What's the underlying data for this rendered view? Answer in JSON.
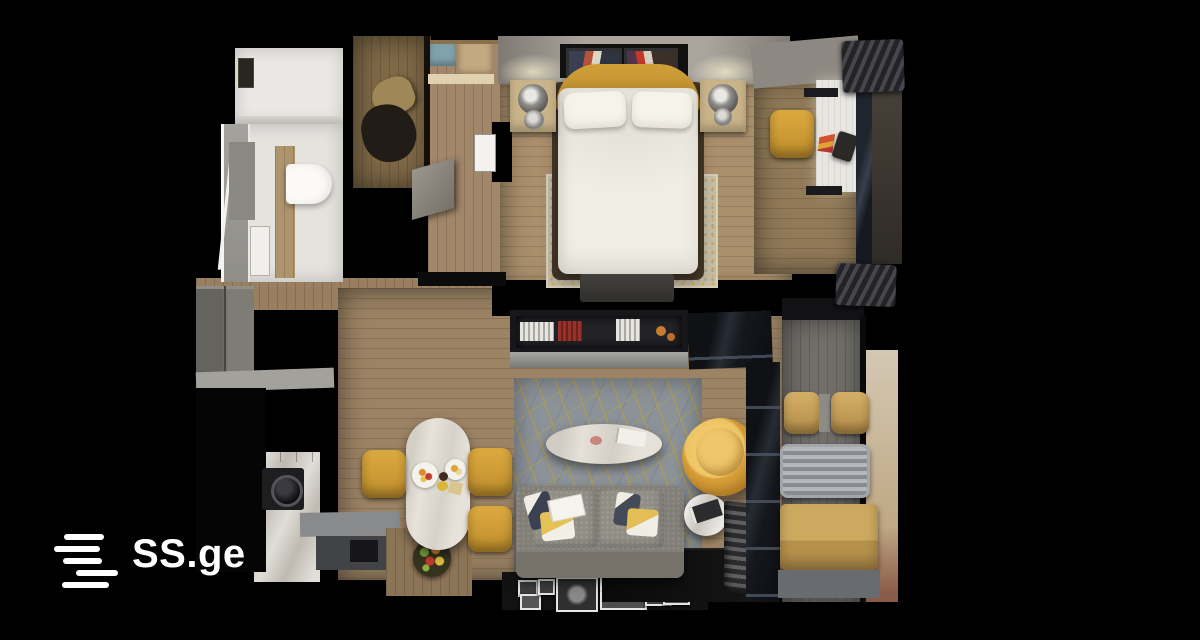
{
  "branding": {
    "logo_text": "SS.ge",
    "logo_color": "#ffffff",
    "logo_icon": "ss-bars-icon"
  },
  "scene": {
    "type": "3d_floorplan_top_view_render",
    "description": "Top-down 3D render of a one-bedroom apartment on a black background with SS.ge watermark",
    "background_color": "#000000",
    "watermark_position": "bottom-left",
    "palette": {
      "wall_cut": "#000000",
      "wood_floor": "#9d8465",
      "accent_yellow": "#d7a038",
      "marble_white": "#e6e1d8",
      "sofa_grey": "#85827a",
      "living_rug": "#8b9298",
      "bedroom_rug": "#c6bda6",
      "balcony_wall_beige": "#cfc3ae",
      "bathroom_white": "#e9e7e3",
      "counter_dark": "#2c2620"
    },
    "rooms": [
      {
        "id": "bathroom",
        "label": "Bathroom",
        "furniture": [
          "shower",
          "toilet",
          "vanity",
          "wood door",
          "cabinet"
        ]
      },
      {
        "id": "wardrobe",
        "label": "Walk-in wardrobe",
        "furniture": [
          "hanging clothes",
          "storage boxes",
          "shelf"
        ]
      },
      {
        "id": "hallway",
        "label": "Hallway",
        "furniture": [
          "open door leaf",
          "white door",
          "entry closet"
        ]
      },
      {
        "id": "bedroom",
        "label": "Bedroom",
        "furniture": [
          "double bed",
          "pillows",
          "yellow throw",
          "speckled rug",
          "nightstands",
          "metal table lamps",
          "wall art frames",
          "tv bench",
          "desk",
          "desk lamp",
          "yellow desk chair",
          "window",
          "curtains"
        ]
      },
      {
        "id": "living-room",
        "label": "Living room",
        "furniture": [
          "bookshelf divider",
          "patterned rug",
          "oval marble coffee table",
          "round yellow lounge chair",
          "grey sofa",
          "cushions",
          "open book",
          "round side table",
          "radiator",
          "gallery picture frames"
        ]
      },
      {
        "id": "kitchen-dining",
        "label": "Kitchen / dining",
        "furniture": [
          "dark kitchen counter",
          "washing machine",
          "sink unit",
          "marble dining table",
          "three yellow chairs",
          "plates with food",
          "fruit bowl"
        ]
      },
      {
        "id": "balcony",
        "label": "Balcony",
        "furniture": [
          "two tan chairs",
          "slatted grey table",
          "tan bench seat"
        ]
      }
    ]
  }
}
